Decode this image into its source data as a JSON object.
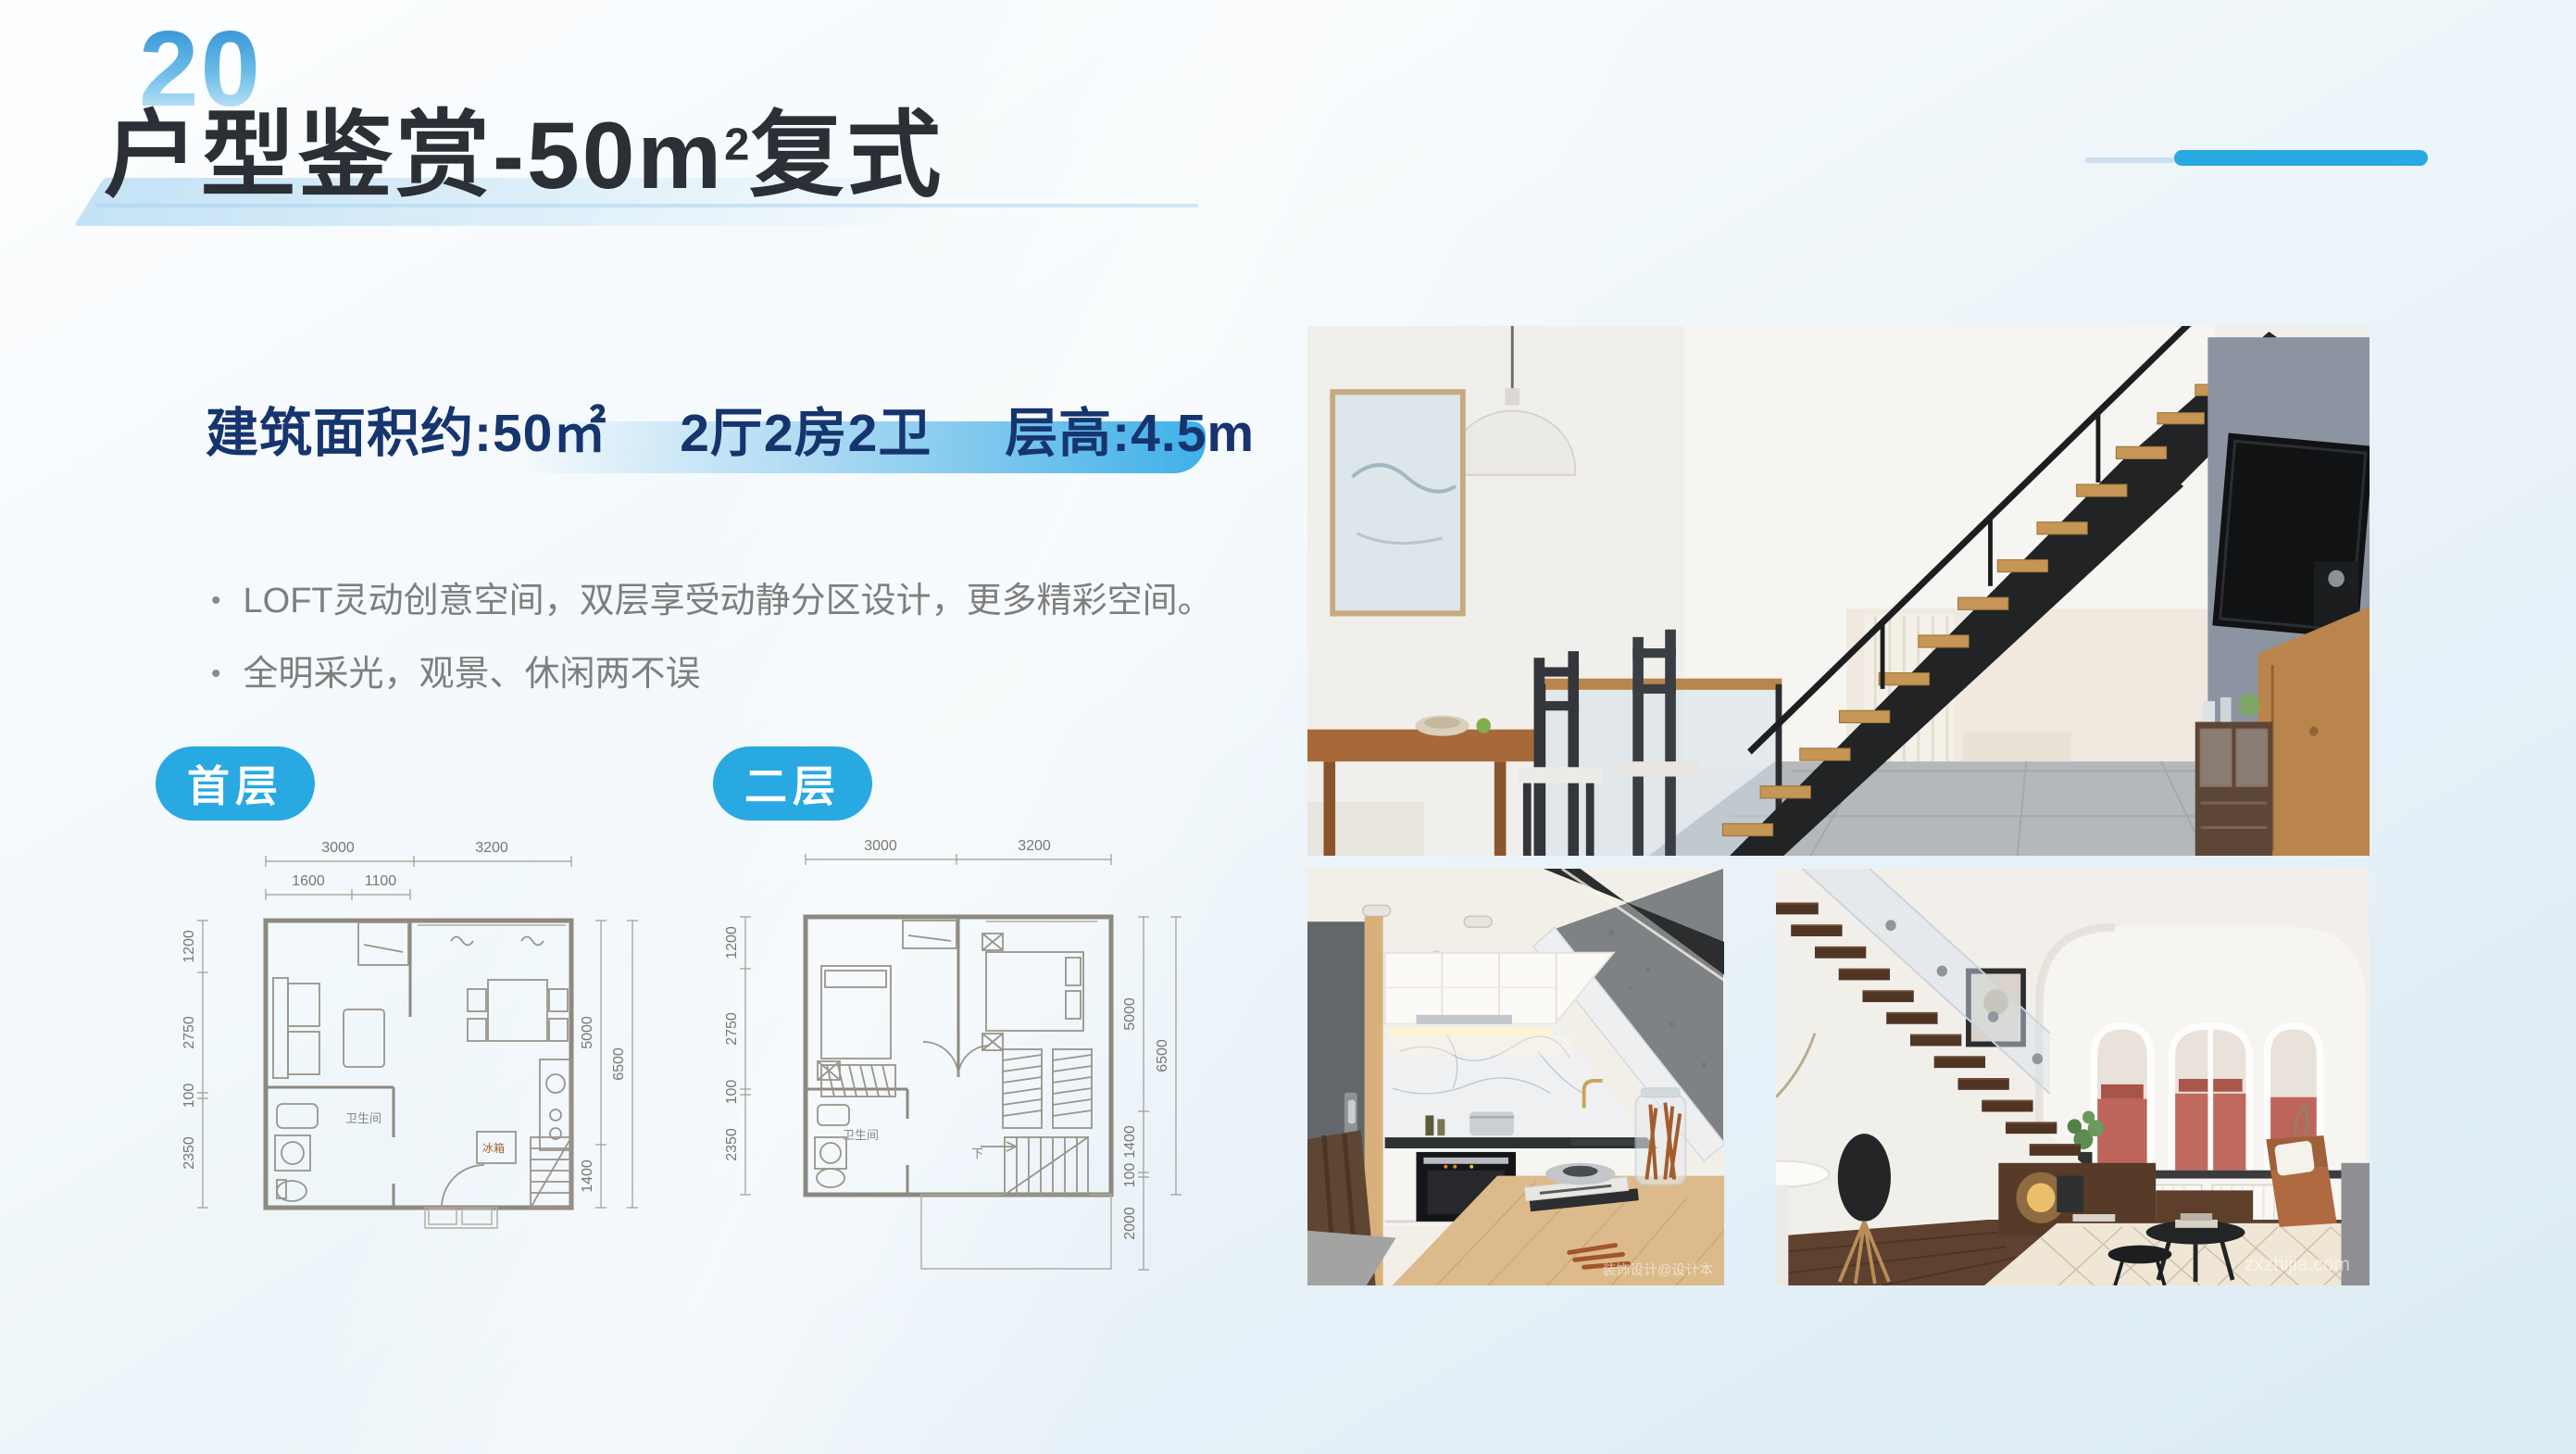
{
  "slide": {
    "page_number": "20",
    "title": {
      "prefix": "户型鉴赏-50m",
      "sup": "2",
      "suffix": "复式"
    },
    "specs": [
      "建筑面积约:50㎡",
      "2厅2房2卫",
      "层高:4.5m"
    ],
    "bullet_char": "•",
    "bullets": [
      "LOFT灵动创意空间，双层享受动静分区设计，更多精彩空间。",
      "全明采光，观景、休闲两不误"
    ],
    "floor_tabs": [
      {
        "label": "首层"
      },
      {
        "label": "二层"
      }
    ]
  },
  "floorplans": {
    "first": {
      "dims_top": [
        "3000",
        "3200"
      ],
      "dims_inner_top": [
        "1600",
        "1100"
      ],
      "dims_left": [
        "1200",
        "2750",
        "100",
        "2350"
      ],
      "dims_right_inner": [
        "5000",
        "1400"
      ],
      "dim_right_outer": "6500",
      "labels": {
        "bathroom": "卫生间",
        "fridge": "冰箱"
      }
    },
    "second": {
      "dims_top": [
        "3000",
        "3200"
      ],
      "dims_left": [
        "1200",
        "2750",
        "100",
        "2350"
      ],
      "dims_right_inner": [
        "5000",
        "1400",
        "100",
        "2000"
      ],
      "dim_right_outer": "6500",
      "labels": {
        "bathroom": "卫生间",
        "down": "下"
      }
    }
  },
  "photos": {
    "kitchen": {
      "watermark": "装饰设计@设计本"
    },
    "living": {
      "watermark": "zxzhijia.com"
    }
  },
  "colors": {
    "accent": "#29a9e2",
    "title": "#2b2f36",
    "navy": "#16356e",
    "bullet_text": "#7e7e7e"
  }
}
